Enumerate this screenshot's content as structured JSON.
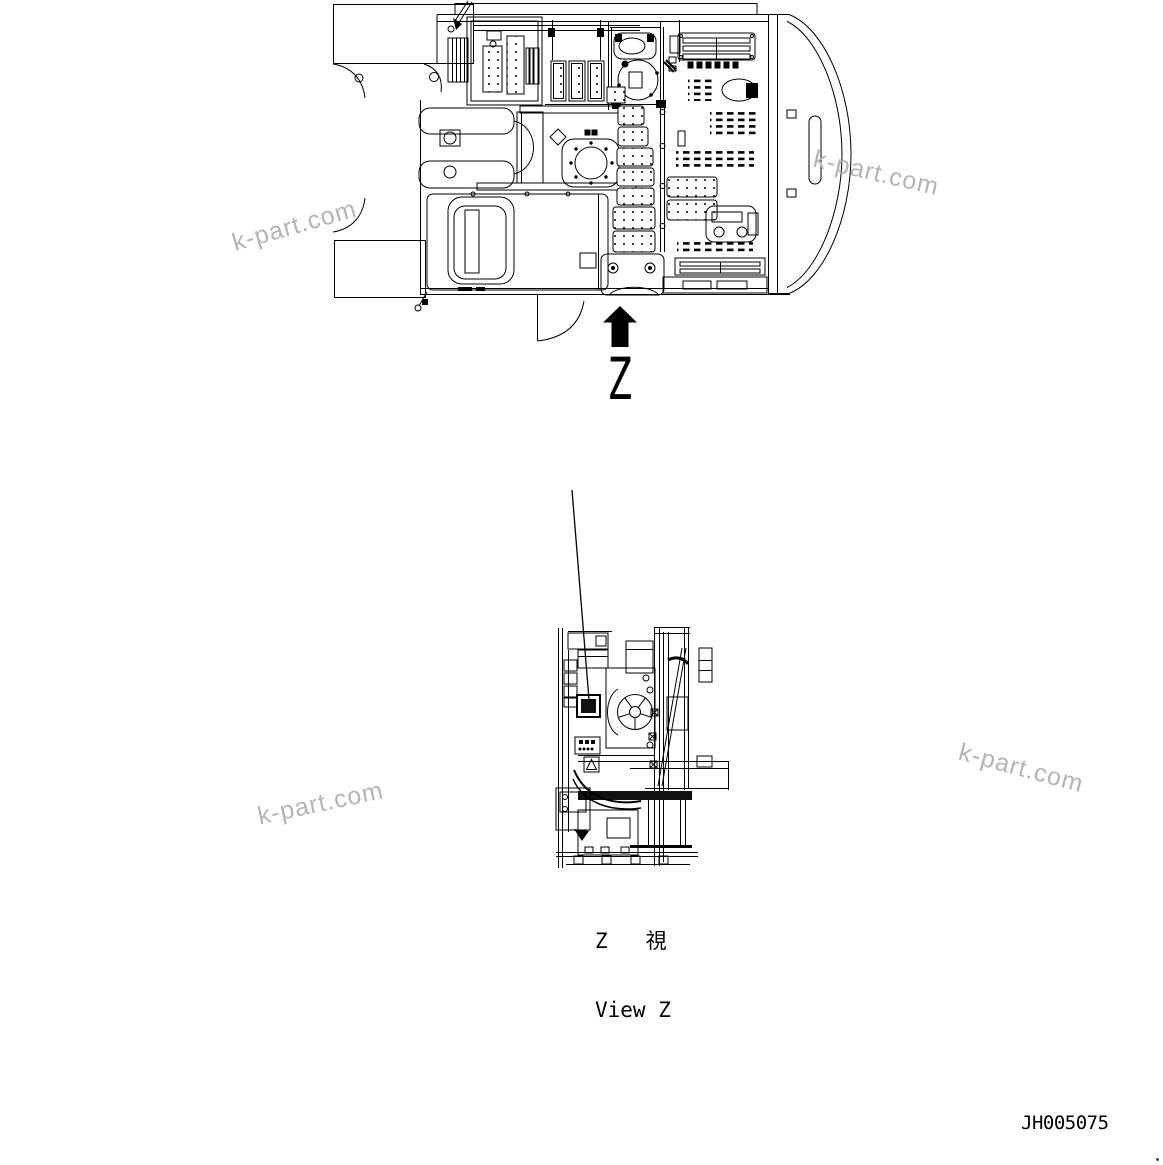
{
  "page": {
    "background_color": "#ffffff",
    "line_color": "#000000",
    "watermark_color": "#b4b4b4",
    "arrow_color": "#000000"
  },
  "drawing": {
    "view_arrow_label": "Z",
    "view_arrow_icon": "filled-up-arrow",
    "view_caption_ja": "Z   視",
    "view_caption_en": "View Z",
    "drawing_number": "JH005075"
  },
  "watermarks": [
    {
      "text": "k-part.com"
    },
    {
      "text": "k-part.com"
    },
    {
      "text": "k-part.com"
    },
    {
      "text": "k-part.com"
    }
  ]
}
